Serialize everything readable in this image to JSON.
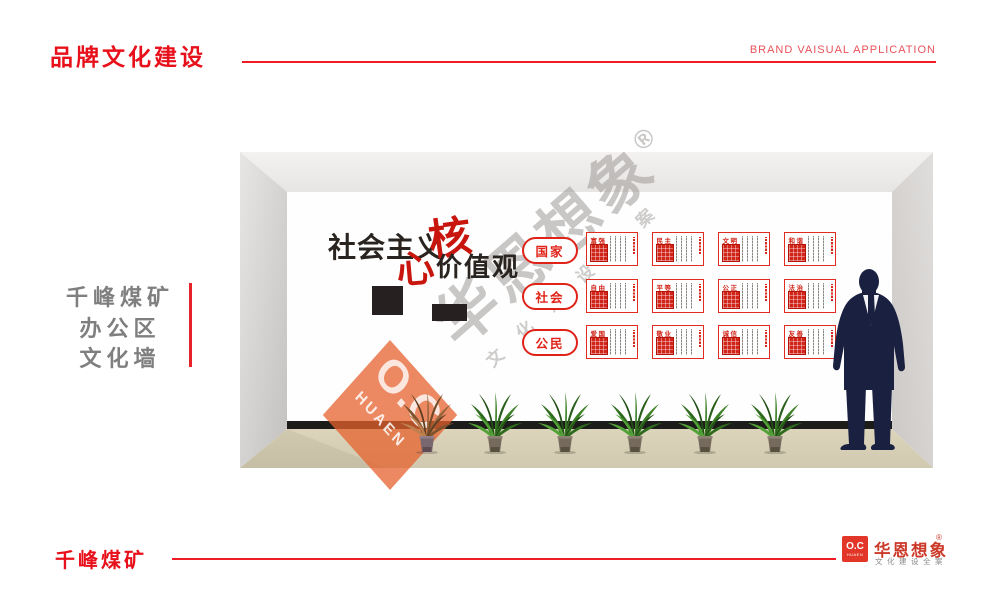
{
  "header": {
    "title": "品牌文化建设",
    "subtitle": "BRAND VAISUAL APPLICATION"
  },
  "side_label": {
    "lines": [
      "千峰煤矿",
      "办公区",
      "文化墙"
    ]
  },
  "wall": {
    "title": {
      "black_lead": "社会主义",
      "red_char1": "核",
      "red_char2": "心",
      "black_tail": "价值观"
    },
    "categories": [
      {
        "label": "国家"
      },
      {
        "label": "社会"
      },
      {
        "label": "公民"
      }
    ],
    "posters": [
      {
        "label": "富强"
      },
      {
        "label": "民主"
      },
      {
        "label": "文明"
      },
      {
        "label": "和谐"
      },
      {
        "label": "自由"
      },
      {
        "label": "平等"
      },
      {
        "label": "公正"
      },
      {
        "label": "法治"
      },
      {
        "label": "爱国"
      },
      {
        "label": "敬业"
      },
      {
        "label": "诚信"
      },
      {
        "label": "友善"
      }
    ]
  },
  "watermark": {
    "big": "华恩想象",
    "reg": "®",
    "small": "文化建设全案",
    "diamond_main": "O.C",
    "diamond_sub": "HUAEN"
  },
  "footer": {
    "client": "千峰煤矿",
    "logo_main": "O.C",
    "logo_sub": "HUAEN",
    "brand": "华恩想象",
    "reg": "®",
    "tagline": "文化建设全案"
  },
  "colors": {
    "accent_red": "#e8111b",
    "poster_red": "#e02c1f",
    "calligraphy_red": "#c8150e",
    "floor_beige": "#d8d0b6",
    "silhouette_navy": "#1a2040",
    "watermark_orange": "rgba(230,97,45,0.75)",
    "side_text_gray": "#7f7f7f"
  }
}
